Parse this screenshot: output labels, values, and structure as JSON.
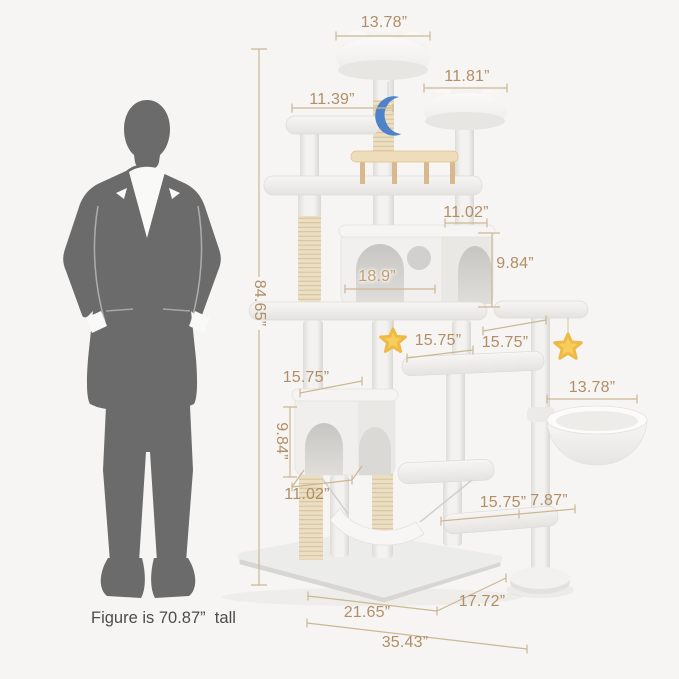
{
  "palette": {
    "background": "#f6f5f3",
    "dimension_text": "#b28e66",
    "dimension_line": "#ccb794",
    "caption_text": "#4c4c4c",
    "plush": "#f3f2f0",
    "sisal": "#eadfc4",
    "wood": "#eedcba",
    "moon": "#4e82cb",
    "star": "#f8cd5b",
    "silhouette": "#6b6b6b"
  },
  "scale_figure": {
    "caption": "Figure is 70.87”  tall"
  },
  "dimensions": {
    "top_cloud_width": "13.78”",
    "right_cloud_width": "11.81”",
    "left_perch_width": "11.39”",
    "upper_condo_top_width": "11.02”",
    "upper_condo_height": "9.84”",
    "upper_condo_depth": "18.9”",
    "total_height": "84.65”",
    "mid_platform_width": "15.75”",
    "right_platform_width": "15.75”",
    "lower_condo_top_width": "15.75”",
    "lower_condo_height": "9.84”",
    "lower_condo_bottom_width": "11.02”",
    "basket_width": "13.78”",
    "bottom_platform_width": "15.75”",
    "bottom_step_width": "7.87”",
    "base_front_width": "21.65”",
    "base_side_depth": "17.72”",
    "total_width": "35.43”"
  }
}
